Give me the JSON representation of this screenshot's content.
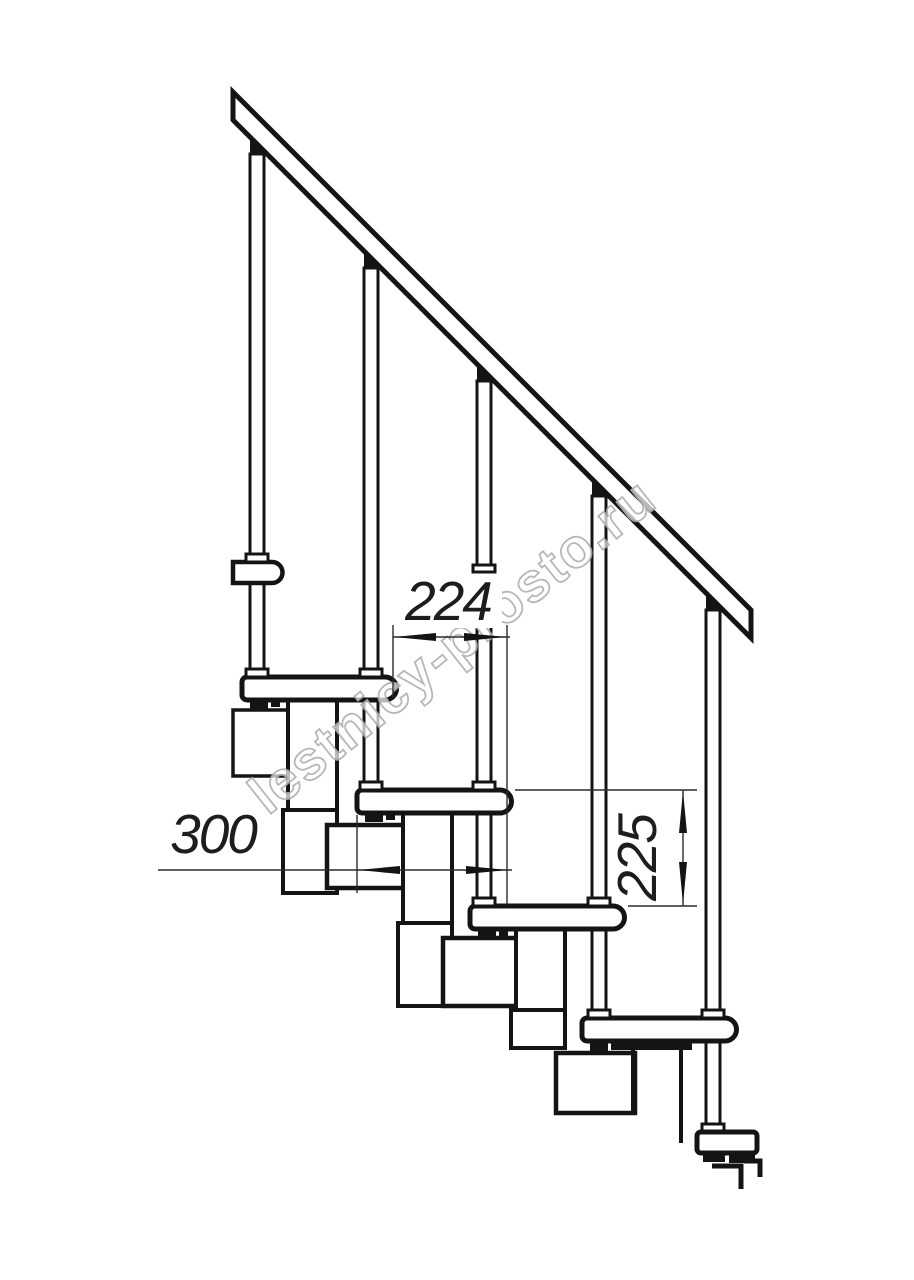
{
  "drawing": {
    "description": "Side elevation technical drawing of a modular staircase with railing",
    "background": "#ffffff",
    "line_color": "#141414",
    "dimension_color": "#2b2b2b",
    "dims": {
      "run": {
        "value": "224",
        "orientation": "horizontal"
      },
      "depth": {
        "value": "300",
        "orientation": "horizontal"
      },
      "rise": {
        "value": "225",
        "orientation": "vertical"
      }
    },
    "watermark": {
      "text": "lestnicy-prosto.ru",
      "outline_color": "#b0b0b0"
    }
  }
}
